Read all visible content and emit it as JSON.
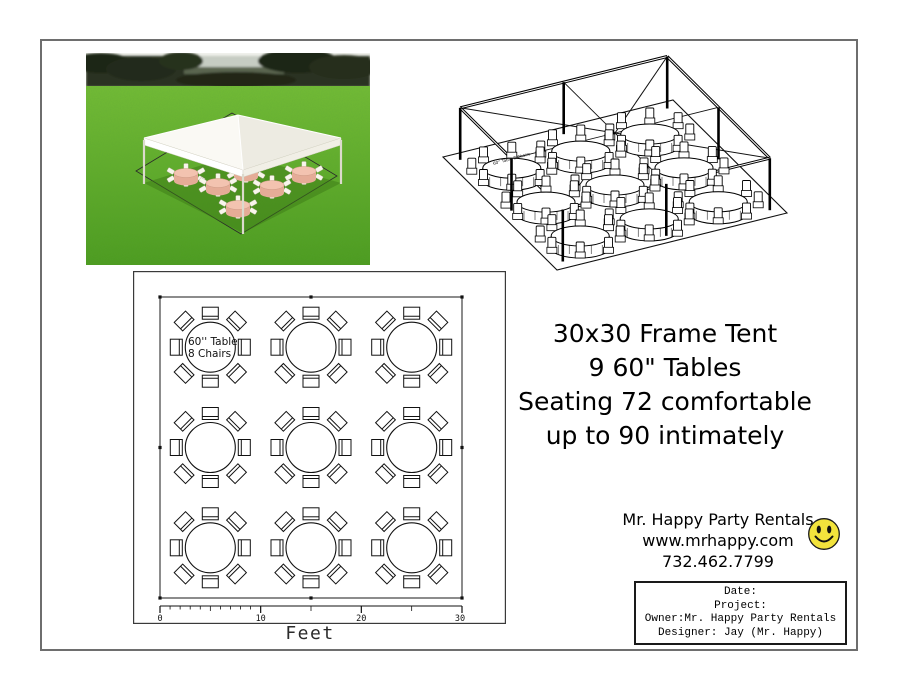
{
  "page": {
    "background": "#ffffff",
    "border_color": "#6e6e6e"
  },
  "summary": {
    "lines": [
      "30x30 Frame Tent",
      "9 60\" Tables",
      "Seating 72 comfortable",
      "up to 90 intimately"
    ]
  },
  "contact": {
    "company": "Mr. Happy Party Rentals",
    "website": "www.mrhappy.com",
    "phone": "732.462.7799",
    "smiley_color": "#f2e33c"
  },
  "title_block": {
    "date_label": "Date:",
    "project_label": "Project:",
    "owner_line": "Owner:Mr. Happy Party Rentals",
    "designer_line": "Designer: Jay (Mr. Happy)"
  },
  "floor_plan": {
    "table_label_line1": "60'' Table",
    "table_label_line2": "8 Chairs",
    "scale_ticks": [
      "0",
      "10",
      "20",
      "30"
    ],
    "scale_unit": "Feet",
    "table_count": 9,
    "chairs_per_table": 8
  },
  "wireframe": {
    "table_note": "60'' Table 8 Chairs",
    "table_count": 9,
    "chairs_per_table": 8
  },
  "photo": {
    "grass_color": "#5cab24",
    "canopy_color": "#f6f5ef",
    "tablecloth_color": "#eebcaa"
  }
}
